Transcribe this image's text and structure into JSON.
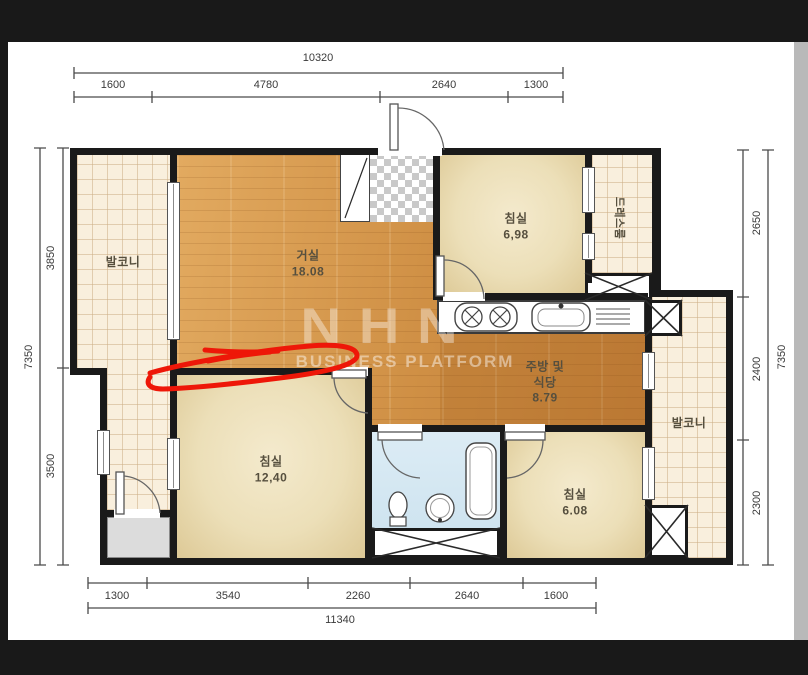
{
  "colors": {
    "wall": "#1a1a1a",
    "wood": "#cf8f44",
    "floor_cream": "#f9efdd",
    "bath_blue": "#dcecf5",
    "annotation_red": "#ee1708",
    "frame_dark": "#191919",
    "right_strip": "#b9b9b9"
  },
  "watermark": {
    "logo": "NHN",
    "subtitle": "BUSINESS PLATFORM"
  },
  "rooms": {
    "living": {
      "name": "거실",
      "area": "18.08"
    },
    "bedroom_top": {
      "name": "침실",
      "area": "6,98"
    },
    "bedroom_left": {
      "name": "침실",
      "area": "12,40"
    },
    "bedroom_right": {
      "name": "침실",
      "area": "6.08"
    },
    "kitchen": {
      "name_line1": "주방 및",
      "name_line2": "식당",
      "area": "8.79"
    },
    "balcony_left": {
      "name": "발코니"
    },
    "balcony_right": {
      "name": "발코니"
    },
    "dress": {
      "name": "드레스룸"
    }
  },
  "dims": {
    "top": {
      "overall": "10320",
      "seg": [
        "1600",
        "4780",
        "2640",
        "1300"
      ]
    },
    "bottom": {
      "overall": "11340",
      "seg": [
        "1300",
        "3540",
        "2260",
        "2640",
        "1600"
      ]
    },
    "left": {
      "overall": "7350",
      "seg": [
        "3850",
        "3500"
      ]
    },
    "right": {
      "overall": "7350",
      "seg": [
        "2650",
        "2400",
        "2300"
      ]
    }
  }
}
